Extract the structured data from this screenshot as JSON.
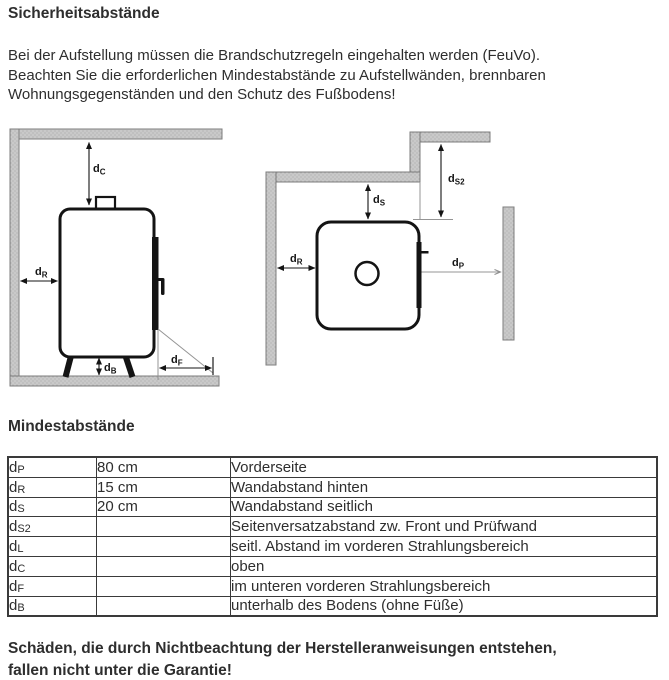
{
  "page": {
    "title": "Sicherheitsabstände",
    "intro": {
      "lines": [
        "Bei der Aufstellung müssen die Brandschutzregeln eingehalten werden (FeuVo).",
        "Beachten Sie die erforderlichen Mindestabstände zu Aufstellwänden, brennbaren",
        "Wohnungsgegenständen und den Schutz des Fußbodens!"
      ]
    },
    "section_title": "Mindestabstände",
    "warning": {
      "lines": [
        "Schäden, die durch Nichtbeachtung der Herstelleranweisungen entstehen,",
        "fallen nicht unter die Garantie!"
      ]
    }
  },
  "diagram": {
    "front_view": {
      "labels": {
        "dC": {
          "base": "d",
          "sub": "C"
        },
        "dR": {
          "base": "d",
          "sub": "R"
        },
        "dB": {
          "base": "d",
          "sub": "B"
        },
        "dF": {
          "base": "d",
          "sub": "F"
        }
      }
    },
    "top_view": {
      "labels": {
        "dS": {
          "base": "d",
          "sub": "S"
        },
        "dS2": {
          "base": "d",
          "sub": "S2"
        },
        "dR": {
          "base": "d",
          "sub": "R"
        },
        "dP": {
          "base": "d",
          "sub": "P"
        }
      }
    },
    "colors": {
      "wall_fill": "#c9c9c9",
      "wall_stroke": "#7d7d7d",
      "outline": "#141414",
      "thin_line": "#949494"
    }
  },
  "table": {
    "rows": [
      {
        "sym": "d",
        "sub": "P",
        "value": "80 cm",
        "desc": "Vorderseite"
      },
      {
        "sym": "d",
        "sub": "R",
        "value": "15 cm",
        "desc": "Wandabstand hinten"
      },
      {
        "sym": "d",
        "sub": "S",
        "value": "20 cm",
        "desc": "Wandabstand seitlich"
      },
      {
        "sym": "d",
        "sub": "S2",
        "value": "",
        "desc": "Seitenversatzabstand zw. Front und Prüfwand"
      },
      {
        "sym": "d",
        "sub": "L",
        "value": "",
        "desc": "seitl. Abstand im vorderen Strahlungsbereich"
      },
      {
        "sym": "d",
        "sub": "C",
        "value": "",
        "desc": "oben"
      },
      {
        "sym": "d",
        "sub": "F",
        "value": "",
        "desc": "im unteren vorderen Strahlungsbereich"
      },
      {
        "sym": "d",
        "sub": "B",
        "value": "",
        "desc": "unterhalb des Bodens (ohne Füße)"
      }
    ]
  }
}
